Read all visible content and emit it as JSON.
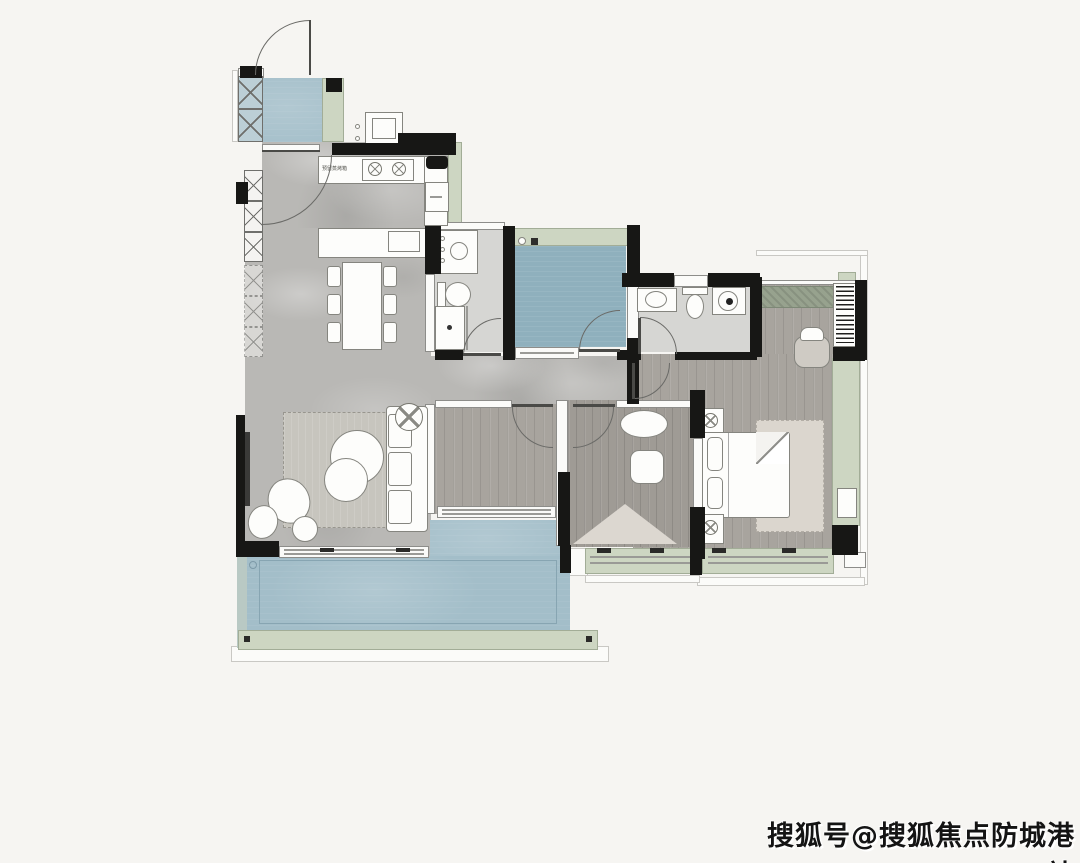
{
  "watermark": {
    "text": "搜狐号@搜狐焦点防城港站"
  },
  "annotations": {
    "kitchen_note": "预留蒸烤箱"
  },
  "colors": {
    "background": "#f6f5f2",
    "wall": "#171715",
    "line": "#6a6a67",
    "marble_floor": "#b9b8b5",
    "wood_floor": "#a8a49e",
    "wood_floor_dark": "#9f9b95",
    "blue_floor": "#a3bec9",
    "blue_floor_deep": "#8fb0bd",
    "window_green": "#cdd6c2",
    "window_green_dark": "#97a28e",
    "bath_floor": "#d6d6d3",
    "rug_living": "#c7c5be",
    "rug_master": "#dbd6ce",
    "furniture_white": "#fdfdfb"
  }
}
